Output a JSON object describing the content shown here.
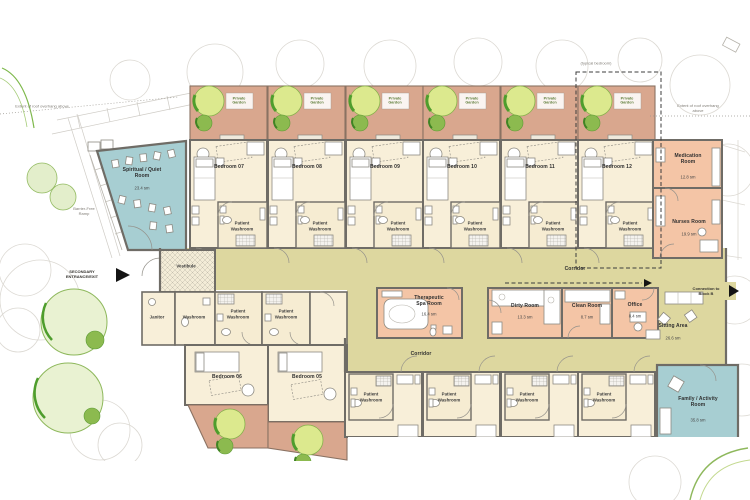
{
  "title_hint": "care-unit floor plan",
  "colors": {
    "bedroom_cream": "#f8efd9",
    "washroom_cream": "#f6ecd2",
    "corridor_olive": "#ddd79f",
    "garden_terracotta": "#d9a78e",
    "service_peach": "#f4c5a6",
    "teal_room": "#a7ced2",
    "wall_gray": "#6f6c66",
    "tree_light": "#dce98e",
    "tree_dark": "#4e9d2d"
  },
  "rooms": {
    "bedrooms_top": [
      {
        "label": "Bedroom 07"
      },
      {
        "label": "Bedroom 08"
      },
      {
        "label": "Bedroom 09"
      },
      {
        "label": "Bedroom 10"
      },
      {
        "label": "Bedroom 11"
      },
      {
        "label": "Bedroom 12"
      }
    ],
    "bedrooms_lower": [
      {
        "label": "Bedroom 06"
      },
      {
        "label": "Bedroom 05"
      }
    ],
    "spiritual_quiet": {
      "label": "Spiritual / Quiet\nRoom",
      "area": "23.4 sm"
    },
    "medication": {
      "label": "Medication\nRoom",
      "area": "12.8 sm"
    },
    "nurses": {
      "label": "Nurses Room",
      "area": "19.9 sm"
    },
    "therapeutic_spa": {
      "label": "Therapeutic\nSpa Room",
      "area": "16.4 sm"
    },
    "dirty": {
      "label": "Dirty Room",
      "area": "13.3 sm"
    },
    "clean": {
      "label": "Clean Room",
      "area": "8.7 sm"
    },
    "office": {
      "label": "Office",
      "area": "8.4 sm"
    },
    "sitting": {
      "label": "Sitting Area",
      "area": "26.6 sm"
    },
    "family_activity": {
      "label": "Family / Activity\nRoom",
      "area": "35.8 sm"
    },
    "vestibule": {
      "label": "Vestibule"
    },
    "janitor": {
      "label": "Janitor"
    },
    "washroom": {
      "label": "Washroom"
    }
  },
  "labels": {
    "patient_washroom": "Patient\nWashroom",
    "private_garden": "Private\nGarden",
    "corridor": "Corridor",
    "typical_bedroom": "(typical bedroom)",
    "roof_overhang": "Extent of roof overhang above",
    "secondary_entrance": "SECONDARY\nENTRANCE/EXIT",
    "barrier_free_ramp": "Barrier-Free\nRamp",
    "connection_block_b": "Connection to\nBlock B"
  }
}
